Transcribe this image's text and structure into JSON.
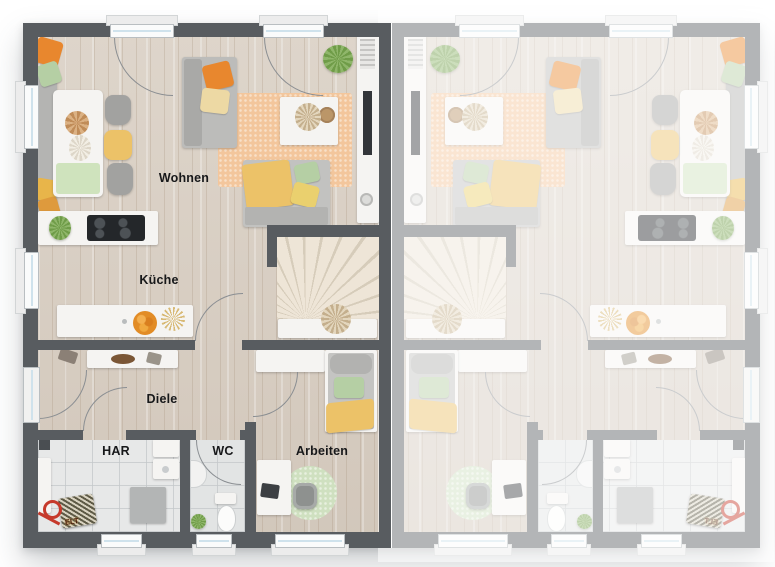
{
  "rooms": {
    "wohnen": {
      "label": "Wohnen"
    },
    "kueche": {
      "label": "Küche"
    },
    "diele": {
      "label": "Diele"
    },
    "har": {
      "label": "HAR"
    },
    "wc": {
      "label": "WC"
    },
    "arbeiten": {
      "label": "Arbeiten"
    }
  },
  "annotations": {
    "elt_label": "ELT"
  },
  "colors": {
    "wall": "#585c60",
    "wood": "#d9cfc3",
    "tile": "#e7e8e8",
    "rug": "#f3c69c",
    "rug_office": "#cfe0c0",
    "orange": "#e8872e",
    "yellow": "#ecc268",
    "green": "#b5cfa4",
    "stairs": "#e6ddcf"
  }
}
